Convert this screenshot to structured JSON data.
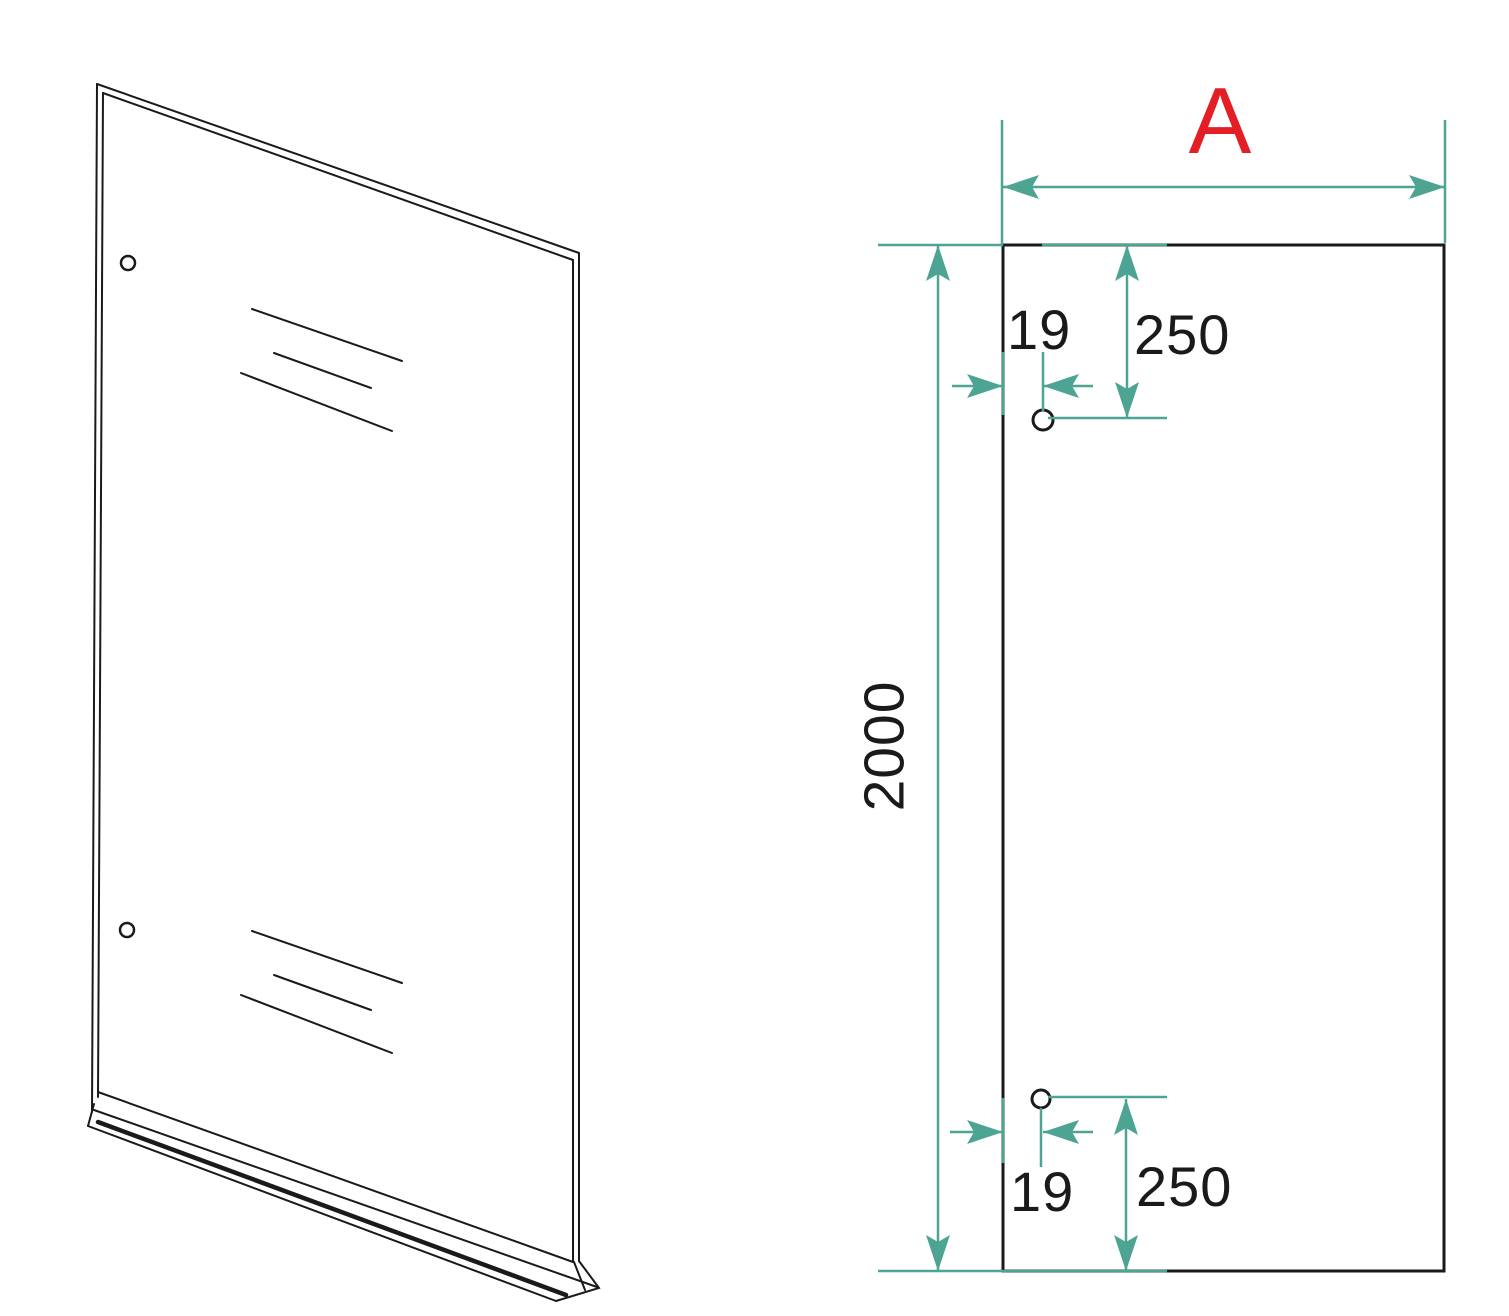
{
  "colors": {
    "line": "#1a1a1a",
    "dimension": "#4DA492",
    "accent": "#E31E24",
    "background": "#ffffff"
  },
  "front_view": {
    "width_label": "A",
    "height_dimension": "2000",
    "top_hole": {
      "edge_offset": "19",
      "top_offset": "250"
    },
    "bottom_hole": {
      "edge_offset": "19",
      "bottom_offset": "250"
    }
  },
  "perspective_view": {
    "hole_count": 2,
    "reflection_line_count": 6
  }
}
